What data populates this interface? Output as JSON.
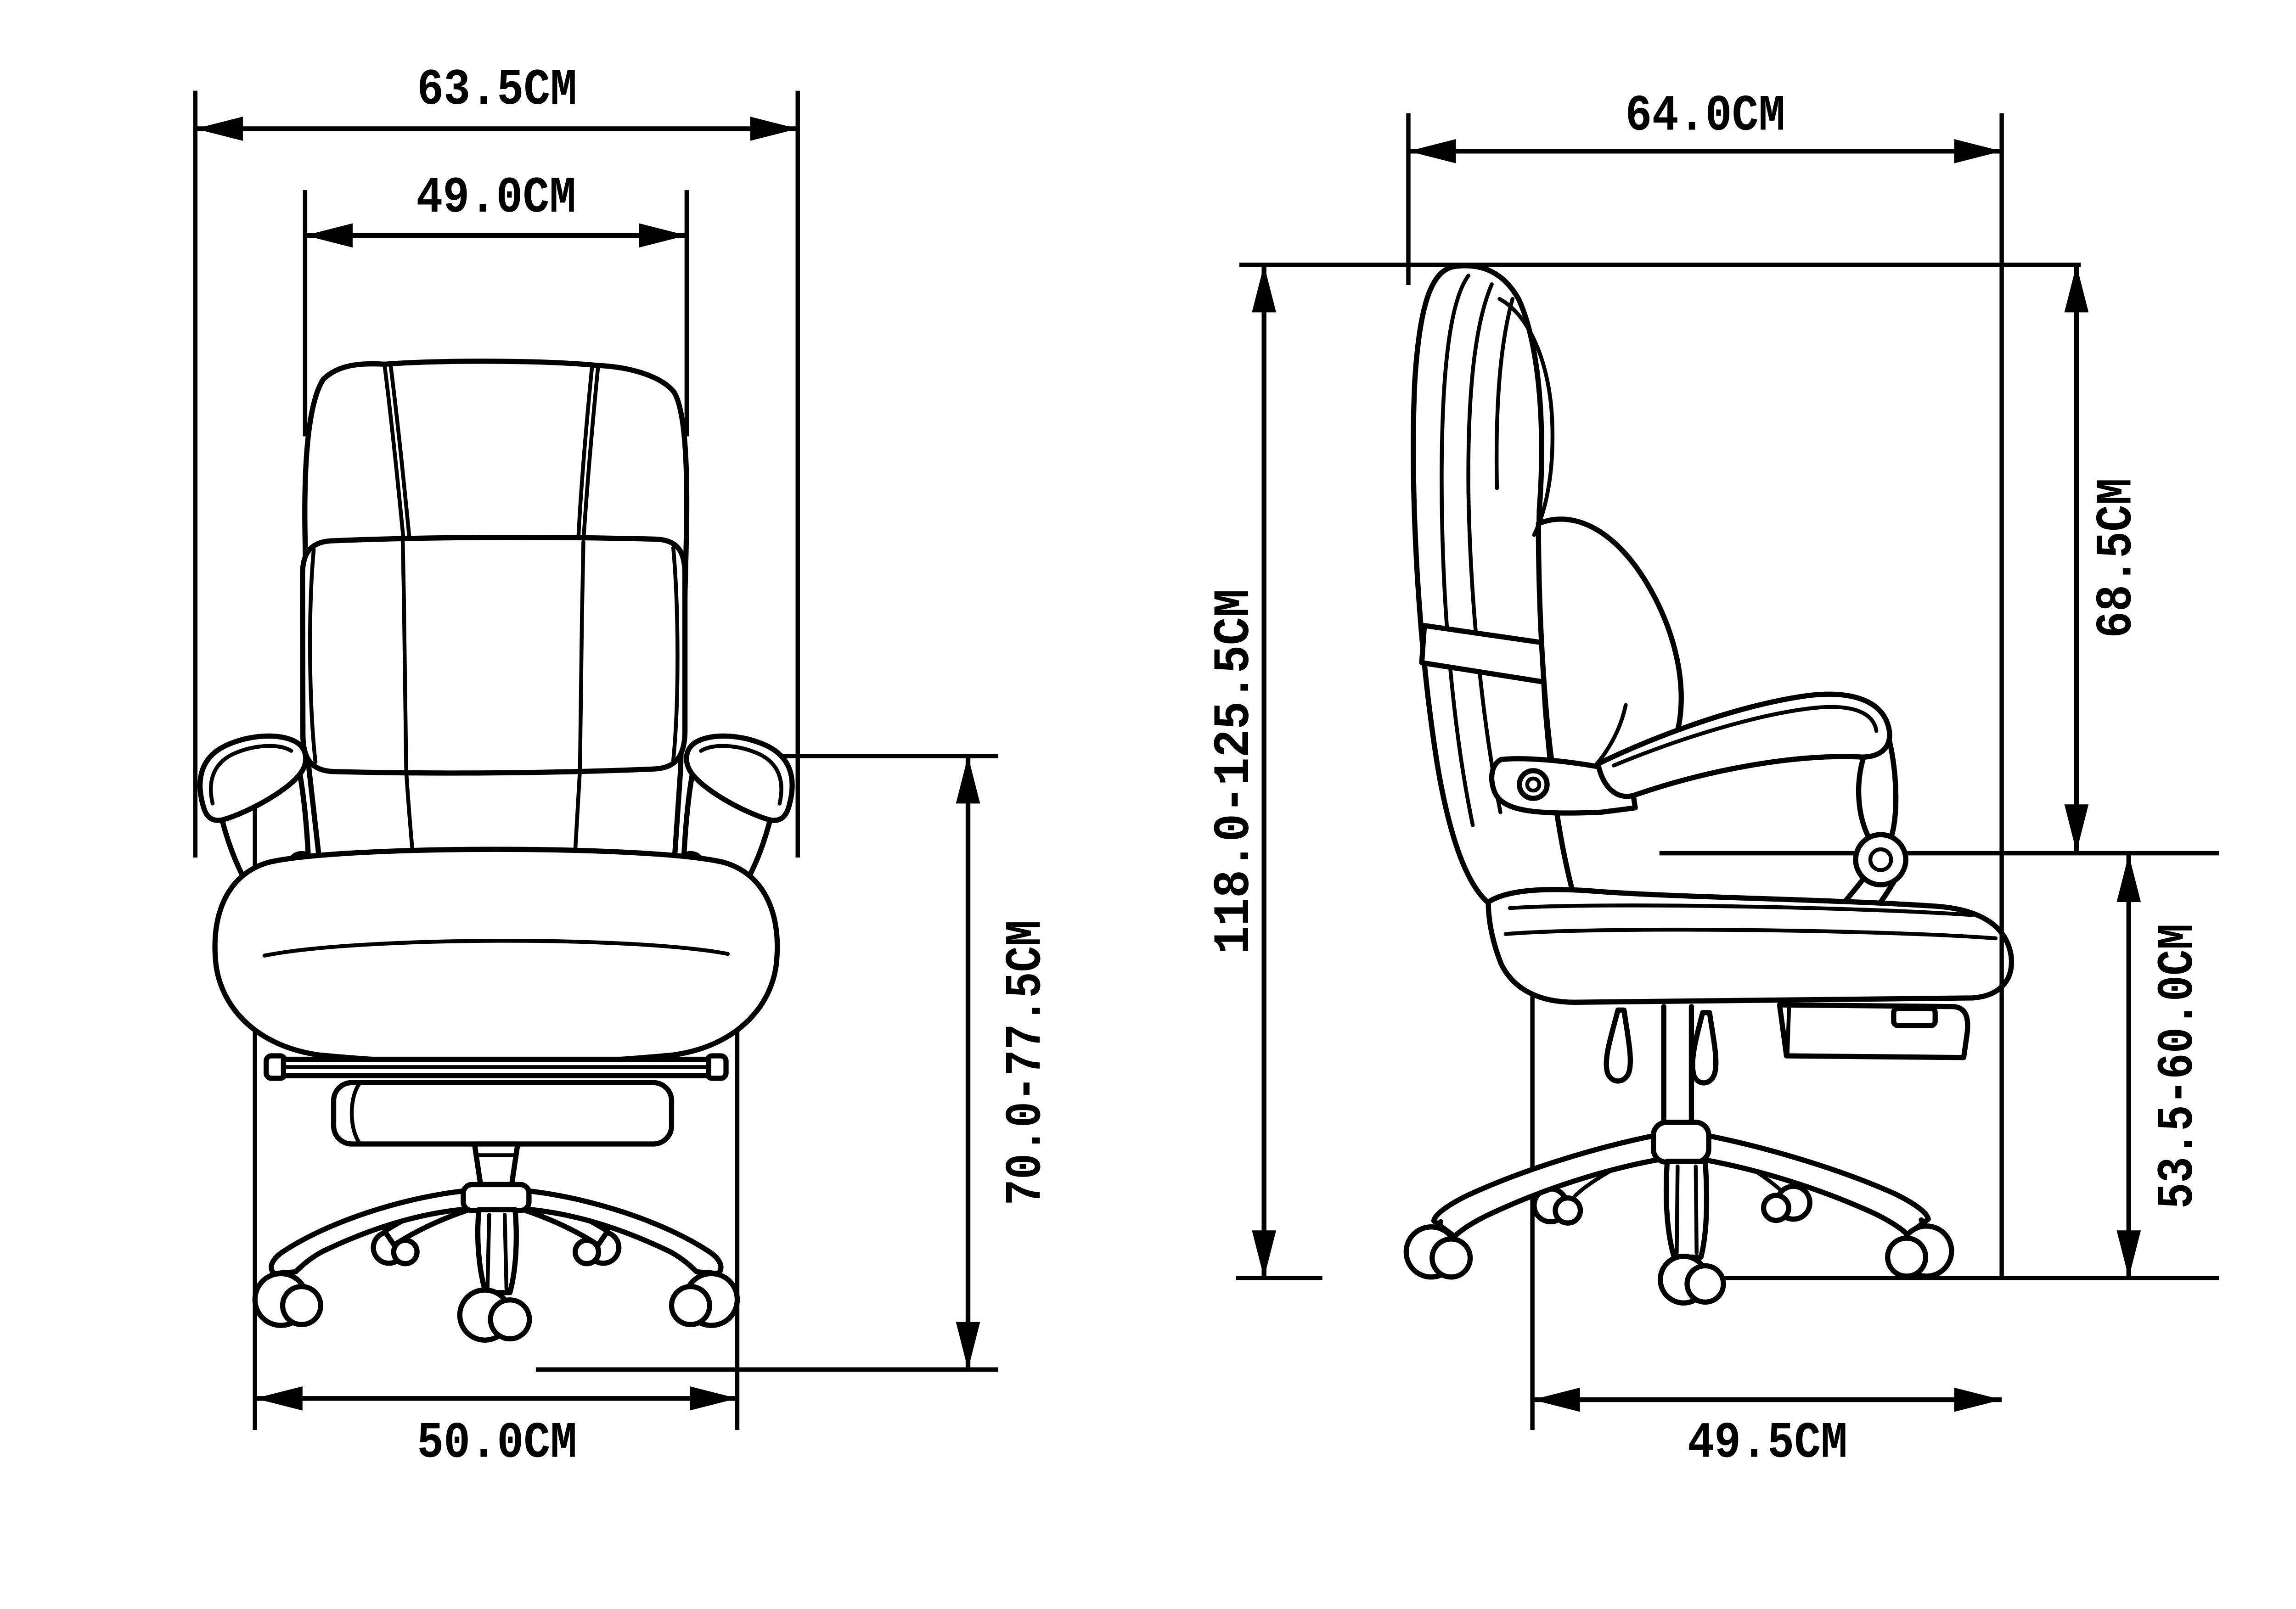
{
  "diagram": {
    "subject": "office chair dimension drawing",
    "unit": "CM",
    "colors": {
      "line": "#000000",
      "background": "#ffffff"
    },
    "views": {
      "front": {
        "name": "front view"
      },
      "side": {
        "name": "side view"
      }
    }
  },
  "dims": {
    "front_overall_width": {
      "label": "63.5CM",
      "value_cm": 63.5,
      "orientation": "horizontal",
      "view": "front"
    },
    "front_backrest_width": {
      "label": "49.0CM",
      "value_cm": 49.0,
      "orientation": "horizontal",
      "view": "front"
    },
    "front_armrest_height": {
      "label": "70.0-77.5CM",
      "min_cm": 70.0,
      "max_cm": 77.5,
      "orientation": "vertical",
      "view": "front"
    },
    "front_base_width": {
      "label": "50.0CM",
      "value_cm": 50.0,
      "orientation": "horizontal",
      "view": "front"
    },
    "side_overall_depth": {
      "label": "64.0CM",
      "value_cm": 64.0,
      "orientation": "horizontal",
      "view": "side"
    },
    "side_overall_height": {
      "label": "118.0-125.5CM",
      "min_cm": 118.0,
      "max_cm": 125.5,
      "orientation": "vertical",
      "view": "side"
    },
    "side_backrest_height": {
      "label": "68.5CM",
      "value_cm": 68.5,
      "orientation": "vertical",
      "view": "side"
    },
    "side_seat_height": {
      "label": "53.5-60.0CM",
      "min_cm": 53.5,
      "max_cm": 60.0,
      "orientation": "vertical",
      "view": "side"
    },
    "side_seat_depth": {
      "label": "49.5CM",
      "value_cm": 49.5,
      "orientation": "horizontal",
      "view": "side"
    }
  }
}
